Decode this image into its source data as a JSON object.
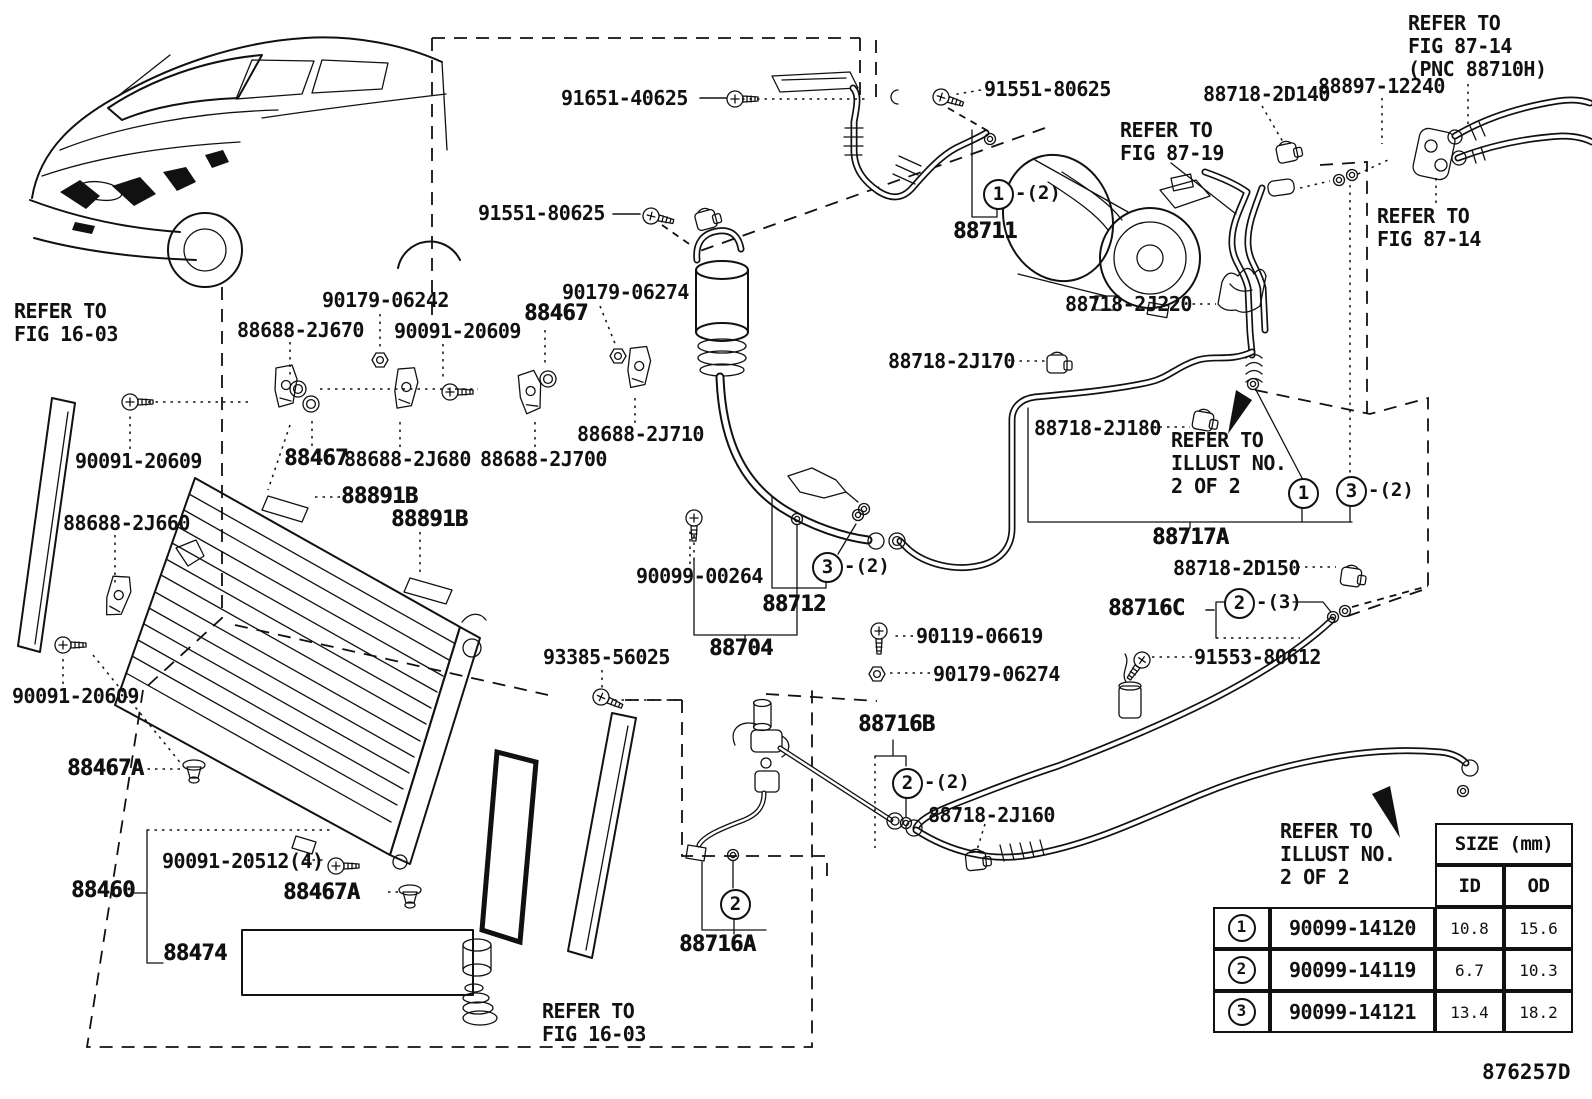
{
  "figure": {
    "code": "876257D"
  },
  "part_labels": [
    {
      "text": "91651-40625",
      "x": 561,
      "y": 88,
      "big": false
    },
    {
      "text": "91551-80625",
      "x": 984,
      "y": 79,
      "big": false
    },
    {
      "text": "88718-2D140",
      "x": 1203,
      "y": 84,
      "big": false
    },
    {
      "text": "88897-12240",
      "x": 1318,
      "y": 76,
      "big": false
    },
    {
      "text": "91551-80625",
      "x": 478,
      "y": 203,
      "big": false
    },
    {
      "text": "90179-06242",
      "x": 322,
      "y": 290,
      "big": false
    },
    {
      "text": "90179-06274",
      "x": 562,
      "y": 282,
      "big": false
    },
    {
      "text": "88467",
      "x": 524,
      "y": 303,
      "big": true
    },
    {
      "text": "88688-2J670",
      "x": 237,
      "y": 320,
      "big": false
    },
    {
      "text": "90091-20609",
      "x": 394,
      "y": 321,
      "big": false
    },
    {
      "text": "88718-2J220",
      "x": 1065,
      "y": 294,
      "big": false
    },
    {
      "text": "88718-2J170",
      "x": 888,
      "y": 351,
      "big": false
    },
    {
      "text": "88688-2J710",
      "x": 577,
      "y": 424,
      "big": false
    },
    {
      "text": "88688-2J680",
      "x": 344,
      "y": 449,
      "big": false
    },
    {
      "text": "88688-2J700",
      "x": 480,
      "y": 449,
      "big": false
    },
    {
      "text": "88467",
      "x": 284,
      "y": 448,
      "big": true
    },
    {
      "text": "88718-2J180",
      "x": 1034,
      "y": 418,
      "big": false
    },
    {
      "text": "88688-2J660",
      "x": 63,
      "y": 513,
      "big": false
    },
    {
      "text": "90091-20609",
      "x": 75,
      "y": 451,
      "big": false
    },
    {
      "text": "88891B",
      "x": 341,
      "y": 486,
      "big": true
    },
    {
      "text": "88891B",
      "x": 391,
      "y": 509,
      "big": true
    },
    {
      "text": "88711",
      "x": 953,
      "y": 221,
      "big": true
    },
    {
      "text": "88717A",
      "x": 1152,
      "y": 527,
      "big": true
    },
    {
      "text": "88718-2D150",
      "x": 1173,
      "y": 558,
      "big": false
    },
    {
      "text": "88716C",
      "x": 1108,
      "y": 598,
      "big": true
    },
    {
      "text": "91553-80612",
      "x": 1194,
      "y": 647,
      "big": false
    },
    {
      "text": "90099-00264",
      "x": 636,
      "y": 566,
      "big": false
    },
    {
      "text": "88712",
      "x": 762,
      "y": 594,
      "big": true
    },
    {
      "text": "90119-06619",
      "x": 916,
      "y": 626,
      "big": false
    },
    {
      "text": "88704",
      "x": 709,
      "y": 638,
      "big": true
    },
    {
      "text": "90179-06274",
      "x": 933,
      "y": 664,
      "big": false
    },
    {
      "text": "93385-56025",
      "x": 543,
      "y": 647,
      "big": false
    },
    {
      "text": "88716B",
      "x": 858,
      "y": 714,
      "big": true
    },
    {
      "text": "88718-2J160",
      "x": 928,
      "y": 805,
      "big": false
    },
    {
      "text": "88467A",
      "x": 67,
      "y": 758,
      "big": true
    },
    {
      "text": "90091-20512(4)",
      "x": 162,
      "y": 851,
      "big": false
    },
    {
      "text": "88460",
      "x": 71,
      "y": 880,
      "big": true
    },
    {
      "text": "88467A",
      "x": 283,
      "y": 882,
      "big": true
    },
    {
      "text": "88474",
      "x": 163,
      "y": 943,
      "big": true
    },
    {
      "text": "88716A",
      "x": 679,
      "y": 934,
      "big": true
    },
    {
      "text": "90091-20609",
      "x": 12,
      "y": 686,
      "big": false
    }
  ],
  "notes": [
    {
      "lines": [
        "REFER TO",
        "FIG 16-03"
      ],
      "x": 14,
      "y": 300
    },
    {
      "lines": [
        "REFER TO",
        "FIG 87-19"
      ],
      "x": 1120,
      "y": 119
    },
    {
      "lines": [
        "REFER TO",
        "FIG 87-14",
        "(PNC 88710H)"
      ],
      "x": 1408,
      "y": 12
    },
    {
      "lines": [
        "REFER TO",
        "FIG 87-14"
      ],
      "x": 1377,
      "y": 205
    },
    {
      "lines": [
        "REFER TO",
        "ILLUST NO.",
        "2 OF 2"
      ],
      "x": 1171,
      "y": 429
    },
    {
      "lines": [
        "REFER TO",
        "ILLUST NO.",
        "2 OF 2"
      ],
      "x": 1280,
      "y": 820
    },
    {
      "lines": [
        "REFER TO",
        "FIG 16-03"
      ],
      "x": 542,
      "y": 1000
    }
  ],
  "callouts": [
    {
      "num": "1",
      "x": 997,
      "y": 193,
      "suffix": "-(2)"
    },
    {
      "num": "3",
      "x": 826,
      "y": 566,
      "suffix": "-(2)"
    },
    {
      "num": "1",
      "x": 1302,
      "y": 492,
      "suffix": ""
    },
    {
      "num": "3",
      "x": 1350,
      "y": 490,
      "suffix": "-(2)"
    },
    {
      "num": "2",
      "x": 1238,
      "y": 602,
      "suffix": "-(3)"
    },
    {
      "num": "2",
      "x": 906,
      "y": 782,
      "suffix": "-(2)"
    },
    {
      "num": "2",
      "x": 734,
      "y": 903,
      "suffix": ""
    }
  ],
  "size_table": {
    "title": "SIZE (mm)",
    "id_header": "ID",
    "od_header": "OD",
    "rows": [
      {
        "callout": "1",
        "part_number": "90099-14120",
        "id": "10.8",
        "od": "15.6"
      },
      {
        "callout": "2",
        "part_number": "90099-14119",
        "id": "6.7",
        "od": "10.3"
      },
      {
        "callout": "3",
        "part_number": "90099-14121",
        "id": "13.4",
        "od": "18.2"
      }
    ]
  }
}
